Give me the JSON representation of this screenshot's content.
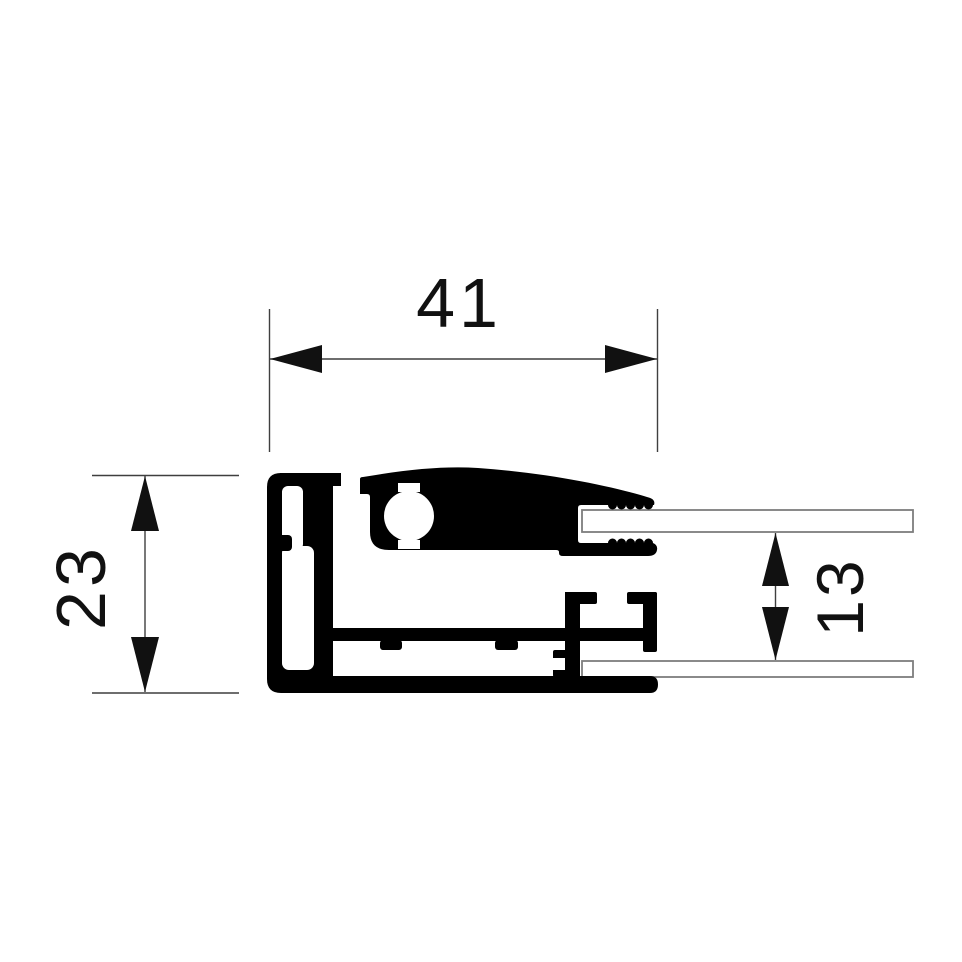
{
  "drawing": {
    "kind": "aluminium-profile-cross-section",
    "labels": {
      "width": "41",
      "height": "23",
      "panel_gap": "13"
    },
    "colors": {
      "profile": "#000000",
      "dimension_lines": "#3f3f3f",
      "dimension_marks": "#111111",
      "panel_outline": "#7e7e7e",
      "panel_fill": "#ffffff",
      "background": "#ffffff"
    }
  }
}
